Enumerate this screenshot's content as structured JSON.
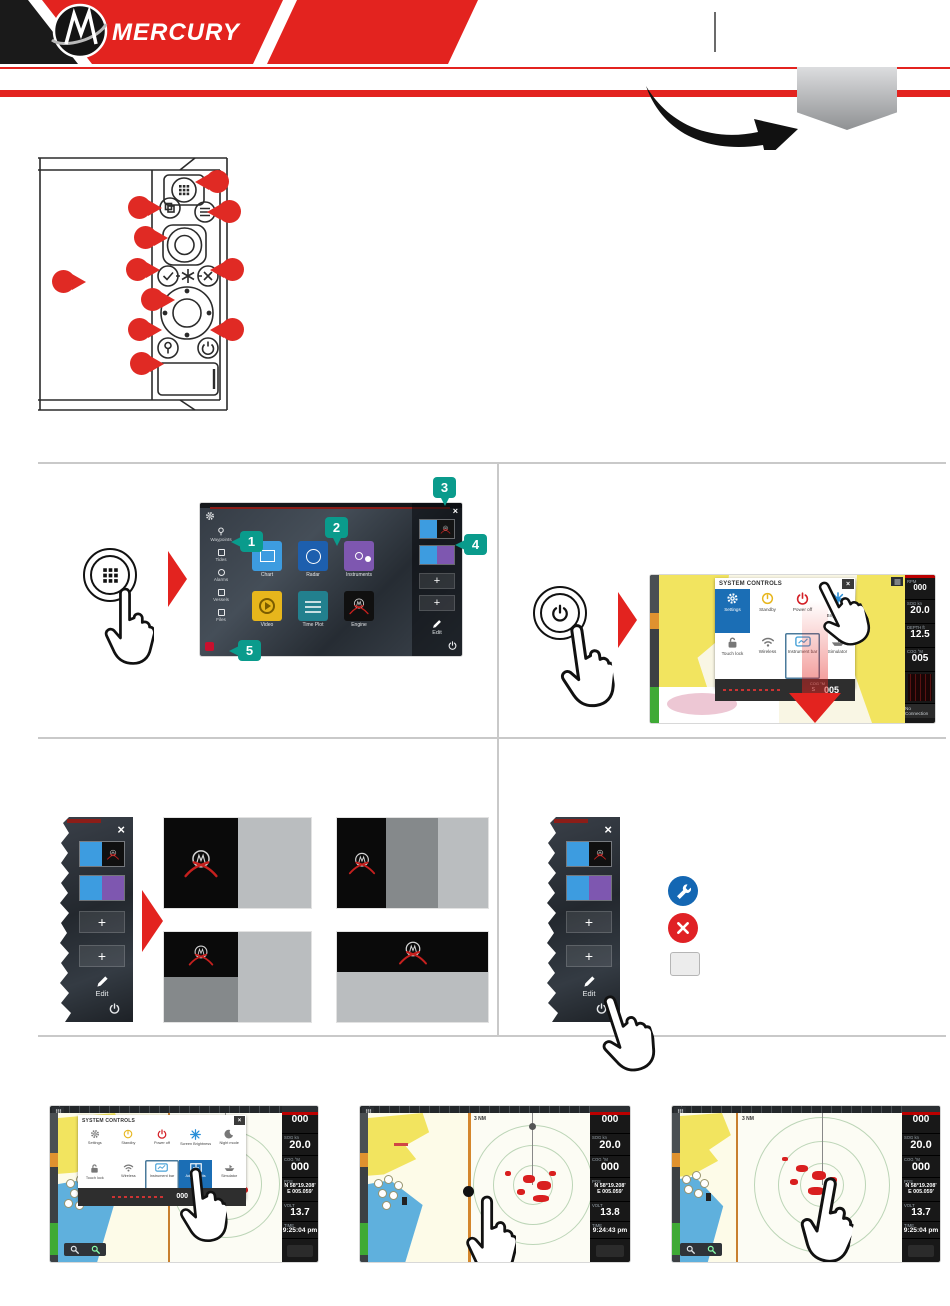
{
  "header": {
    "brand": "MERCURY"
  },
  "colors": {
    "mercury_red": "#e3231f",
    "callout_teal": "#0a9b8c",
    "callout_red": "#e02a24",
    "settings_blue": "#1b6eb5",
    "pane_dark": "#0a0a0a",
    "pane_mid": "#85898b",
    "pane_light": "#babdbf",
    "chart_land": "#f2e45f",
    "chart_water": "#5fb0dd"
  },
  "device": {
    "keys": [
      "apps-key",
      "pages-key",
      "menu-key",
      "rotary-knob",
      "enter-key",
      "mob-key",
      "exit-key",
      "arrow-pad",
      "waypoint-key",
      "power-key",
      "card-reader-door"
    ]
  },
  "callouts": {
    "c1": "1",
    "c2": "2",
    "c3": "3",
    "c4": "4",
    "c5": "5"
  },
  "home": {
    "tools": [
      {
        "label": "Waypoints"
      },
      {
        "label": "Tides"
      },
      {
        "label": "Alarms"
      },
      {
        "label": "Vessels"
      },
      {
        "label": "Files"
      }
    ],
    "apps": [
      {
        "label": "Chart"
      },
      {
        "label": "Radar"
      },
      {
        "label": "Instruments"
      },
      {
        "label": "Video"
      },
      {
        "label": "Time Plot"
      },
      {
        "label": "Engine"
      }
    ],
    "close": "×",
    "edit": "Edit",
    "plus": "+"
  },
  "syscontrols": {
    "title": "SYSTEM CONTROLS",
    "close": "×",
    "row1": [
      {
        "label": "Settings"
      },
      {
        "label": "Standby"
      },
      {
        "label": "Power off"
      },
      {
        "label": "Screen Brightness"
      }
    ],
    "row2": [
      {
        "label": "Touch lock"
      },
      {
        "label": "Wireless"
      },
      {
        "label": "Instrument bar"
      },
      {
        "label": "Simulator"
      }
    ],
    "bar": {
      "label": "COG °M",
      "prefix": "S",
      "value": "005"
    }
  },
  "syscontrols5": {
    "title": "SYSTEM CONTROLS",
    "close": "×",
    "row1": [
      {
        "label": "Settings"
      },
      {
        "label": "Standby"
      },
      {
        "label": "Power off"
      },
      {
        "label": "Screen Brightness"
      },
      {
        "label": "Night mode"
      }
    ],
    "row2": [
      {
        "label": "Touch lock"
      },
      {
        "label": "Wireless"
      },
      {
        "label": "Instrument bar"
      },
      {
        "label": "Adjust splits"
      },
      {
        "label": "Simulator"
      }
    ],
    "bar": {
      "value": "000"
    }
  },
  "instr_a": {
    "rpm_label": "RPM",
    "rpm": "000",
    "sog_label": "SOG kn",
    "sog": "20.0",
    "depth_label": "DEPTH ft",
    "depth": "12.5",
    "cog_label": "COG °M",
    "cog": "005",
    "status": "No Connection"
  },
  "shots": {
    "s1": {
      "rpm": "000",
      "sog_label": "SOG kn",
      "sog": "20.0",
      "cog_label": "COG °M",
      "cog": "000",
      "pos_label": "POS",
      "lat": "N 58°19.208'",
      "lon": "E 005.059'",
      "volt_label": "VOLT",
      "volt": "13.7",
      "time_label": "TIME",
      "time": "9:25:04 pm"
    },
    "s2": {
      "range": "3 NM",
      "rpm": "000",
      "sog_label": "SOG kn",
      "sog": "20.0",
      "cog_label": "COG °M",
      "cog": "000",
      "pos_label": "POS",
      "lat": "N 58°19.208'",
      "lon": "E 005.059'",
      "volt_label": "VOLT",
      "volt": "13.8",
      "time_label": "TIME",
      "time": "9:24:43 pm"
    },
    "s3": {
      "range": "3 NM",
      "rpm": "000",
      "sog_label": "SOG kn",
      "sog": "20.0",
      "cog_label": "COG °M",
      "cog": "000",
      "pos_label": "POS",
      "lat": "N 58°19.208'",
      "lon": "E 005.059'",
      "volt_label": "VOLT",
      "volt": "13.7",
      "time_label": "TIME",
      "time": "9:25:04 pm"
    }
  }
}
